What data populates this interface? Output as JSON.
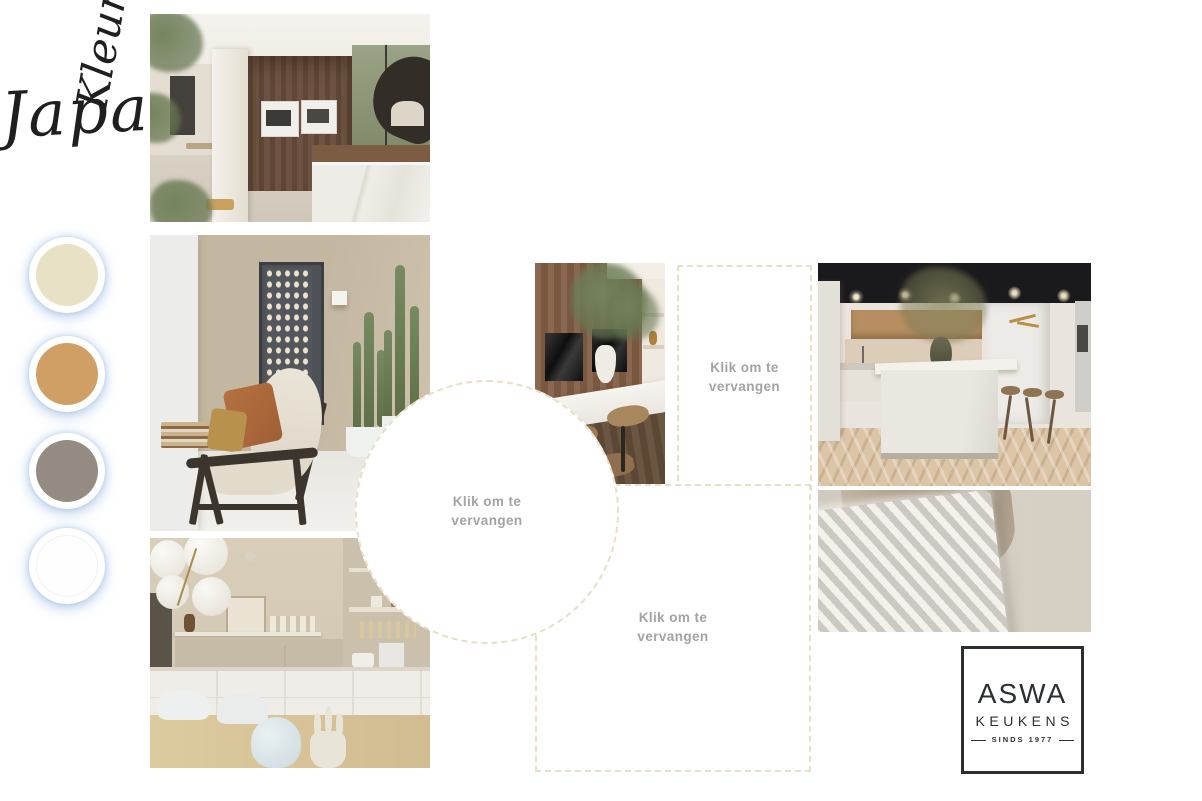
{
  "sidebar": {
    "title": "Kleuren",
    "swatches": [
      {
        "name": "cream",
        "color": "#e9e1c5"
      },
      {
        "name": "camel",
        "color": "#d09f66"
      },
      {
        "name": "taupe",
        "color": "#948b83"
      },
      {
        "name": "white",
        "color": "#fefefe"
      }
    ]
  },
  "board": {
    "title": "Japandi",
    "placeholder_label": "Klik om te vervangen"
  },
  "photos": [
    {
      "name": "open-plan kitchen with walnut cabinet wall and marble island"
    },
    {
      "name": "living room with oak armchair, ring artwork and cacti"
    },
    {
      "name": "cream kitchen with globe chandelier and dining table"
    },
    {
      "name": "walnut kitchen with black built-in ovens and bar stools"
    },
    {
      "name": "kitchen showroom with island, dark ceiling and herringbone floor"
    },
    {
      "name": "close-up of chevron knit and satin cushions"
    }
  ],
  "logo": {
    "brand": "ASWA",
    "sub": "KEUKENS",
    "tagline": "SINDS 1977"
  }
}
